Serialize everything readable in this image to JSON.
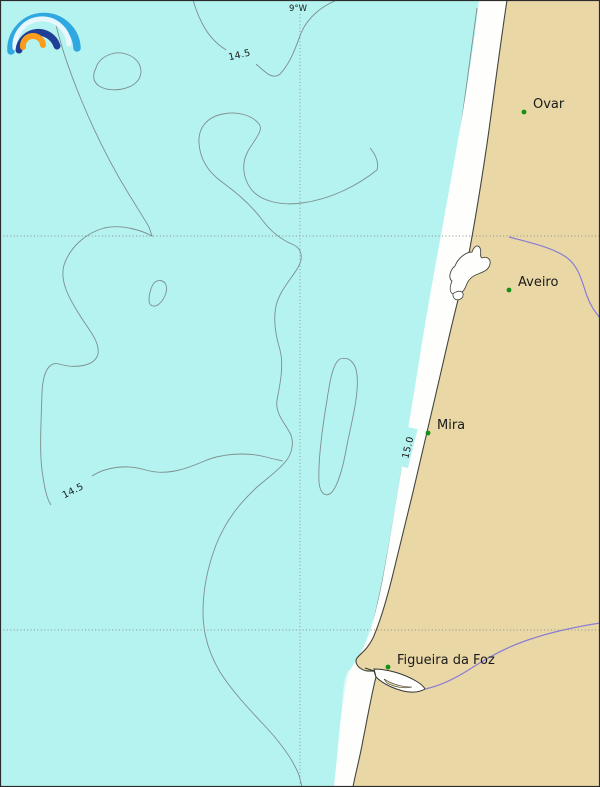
{
  "grid": {
    "meridian_label": "9°W"
  },
  "contours": {
    "upper_left": "14.5",
    "lower_left": "14.5",
    "coastal": "15.0"
  },
  "cities": [
    {
      "name": "Ovar"
    },
    {
      "name": "Aveiro"
    },
    {
      "name": "Mira"
    },
    {
      "name": "Figueira da Foz"
    }
  ],
  "colors": {
    "sea": "#b5f3f1",
    "land": "#e9d8a6",
    "beach": "#fefefc",
    "shallow": "#dcf9f4",
    "contour": "#7e8e8e",
    "river": "#8a7cd6",
    "city_dot": "#149114",
    "grid": "#8c8c8c",
    "coastline": "#45453f",
    "estuary_line": "#333330",
    "label": "#1a1a1a",
    "frame": "#2b2b2b"
  },
  "logo": {
    "outer": "#2fa8e1",
    "pale": "#e8f6fe",
    "dark": "#1f3e96",
    "orange": "#f99d1b"
  }
}
